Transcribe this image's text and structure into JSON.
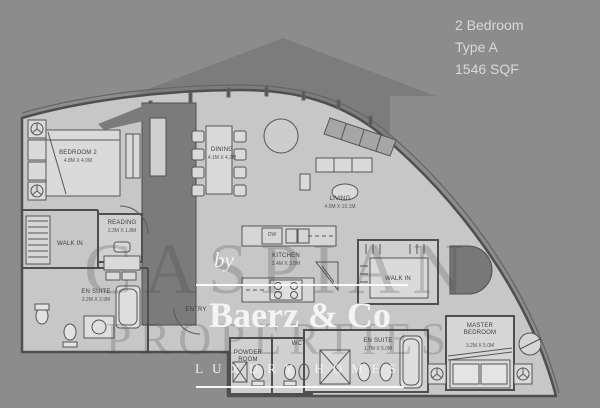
{
  "header": {
    "line1": "2 Bedroom",
    "line2": "Type A",
    "line3": "1546 SQF"
  },
  "logo": {
    "by": "by",
    "brand": "Baerz & Co",
    "tagline": "LUXURY HOMES"
  },
  "background_watermark": {
    "line1": "CASPIAN",
    "line2": "PROPERTIES"
  },
  "rooms": {
    "bedroom2": {
      "name": "BEDROOM 2",
      "dims": "4.8M X 4.0M"
    },
    "reading": {
      "name": "READING",
      "dims": "2.3M X 1.8M"
    },
    "walk_in_left": {
      "name": "WALK IN"
    },
    "en_suite_left": {
      "name": "EN SUITE",
      "dims": "2.2M X 3.9M"
    },
    "dining": {
      "name": "DINING",
      "dims": "4.1M X 4.2M"
    },
    "living": {
      "name": "LIVING",
      "dims": "4.0M X 10.1M"
    },
    "kitchen": {
      "name": "KITCHEN",
      "dims": "2.4M X 3.8M"
    },
    "dishwasher": {
      "name": "DW"
    },
    "entry": {
      "name": "ENTRY"
    },
    "powder_room": {
      "name": "POWDER ROOM"
    },
    "wc": {
      "name": "WC"
    },
    "walk_in_master": {
      "name": "WALK IN"
    },
    "en_suite_master": {
      "name": "EN SUITE",
      "dims": "1.7M X 5.0M"
    },
    "master_bedroom": {
      "name": "MASTER BEDROOM",
      "dims": "3.2M X 5.0M"
    }
  },
  "colors": {
    "background": "#8c8c8c",
    "roof_arrow": "#7c7c7c",
    "plan_fill": "#c7c7c7",
    "room_fill": "#d4d4d4",
    "wall": "#4f4f4f",
    "core_fill": "#7b7b7b",
    "header_text": "#d9d9d9",
    "label_text": "#3f3f3f",
    "logo_text": "#f4f4f4",
    "watermark_text": "#3e3e3e"
  }
}
